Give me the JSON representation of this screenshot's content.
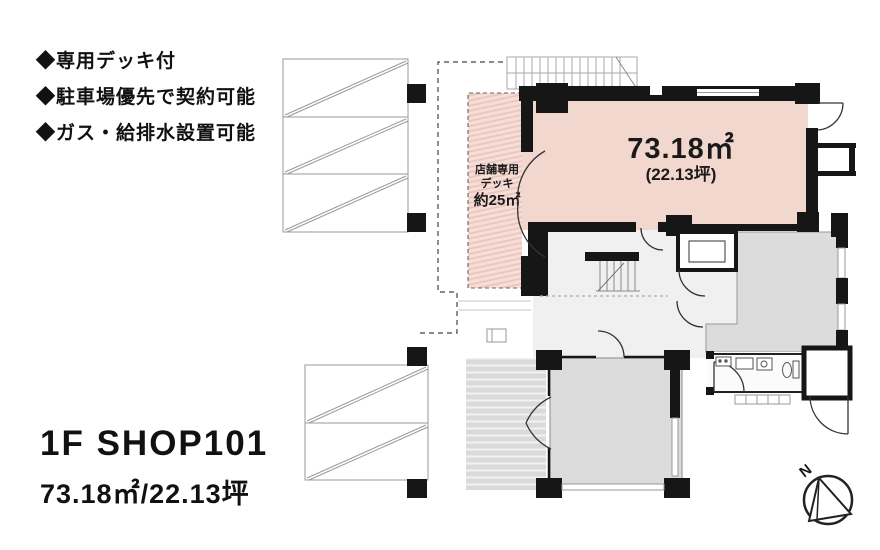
{
  "features": {
    "items": [
      "◆専用デッキ付",
      "◆駐車場優先で契約可能",
      "◆ガス・給排水設置可能"
    ]
  },
  "plan": {
    "main": {
      "area": "73.18㎡",
      "tsubo": "(22.13坪)"
    },
    "deck": {
      "line1": "店舗専用",
      "line2": "デッキ",
      "line3": "約25㎡"
    },
    "compass_label": "N"
  },
  "title": {
    "line1": "1F SHOP101",
    "line2": "73.18㎡/22.13坪"
  },
  "colors": {
    "shop_pink": "#f2d7ce",
    "deck_pink": "#f6ded7",
    "deck_stripe": "#e8c3ba",
    "room_gray": "#dcdcdd",
    "deck_gray": "#dadada",
    "wall_black": "#161616"
  }
}
